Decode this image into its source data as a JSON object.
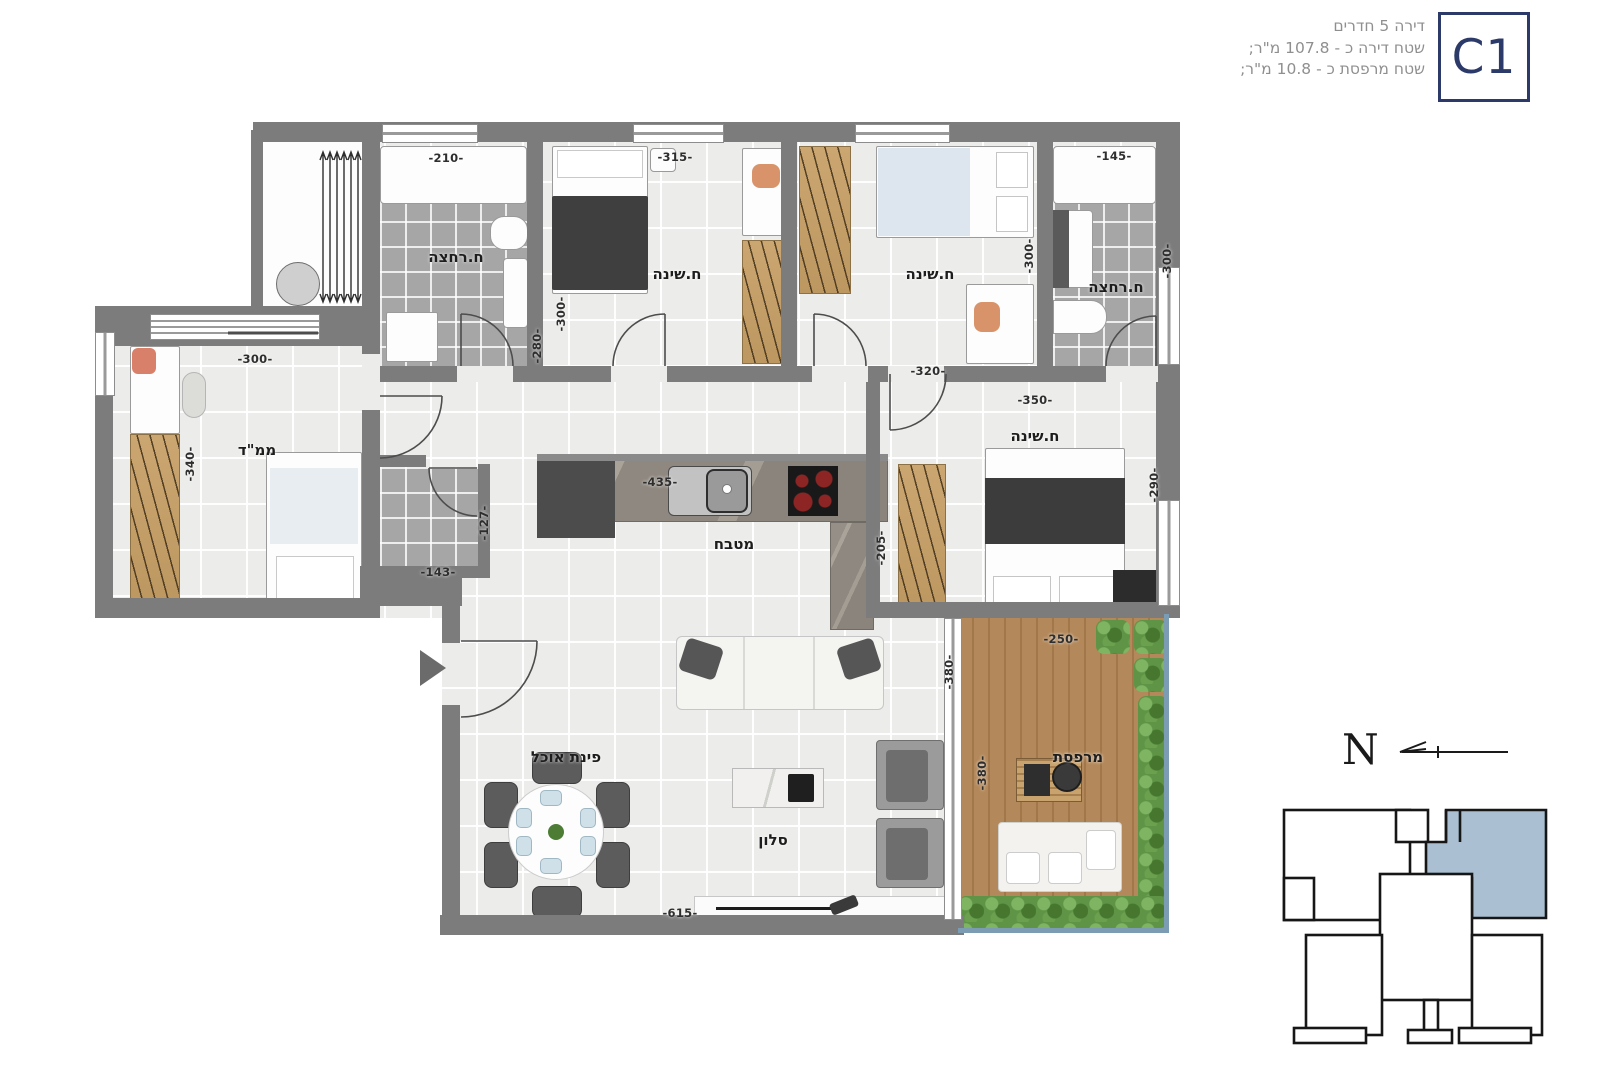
{
  "title_block": {
    "line1": "דירה 5 חדרים",
    "line2": "שטח דירה כ - 107.8 מ\"ר;",
    "line3": "שטח מרפסת כ - 10.8 מ\"ר;",
    "unit_code": "C1"
  },
  "rooms": {
    "bath1": {
      "label": "ח.רחצה",
      "width_dim": "-210-",
      "height_dim": "-280-"
    },
    "bed1": {
      "label": "ח.שינה",
      "width_dim": "-315-",
      "height_dim": "-300-"
    },
    "bed2": {
      "label": "ח.שינה",
      "width_dim": "-320-",
      "height_dim": "-300-"
    },
    "bath2": {
      "label": "ח.רחצה",
      "width_dim": "-145-",
      "height_dim": "-300-"
    },
    "mamad": {
      "label": "ממ\"ד",
      "width_dim": "-300-",
      "height_dim": "-340-"
    },
    "wc": {
      "width_dim": "-143-",
      "height_dim": "-127-"
    },
    "kitchen": {
      "label": "מטבח",
      "width_dim": "-435-",
      "height_dim": "-205-"
    },
    "bed3": {
      "label": "ח.שינה",
      "width_dim": "-350-",
      "height_dim": "-290-"
    },
    "living": {
      "label": "סלון",
      "width_dim": "-615-",
      "height_dim": "-380-"
    },
    "dining": {
      "label": "פינת אוכל"
    },
    "balcony": {
      "label": "מרפסת",
      "width_dim": "-250-",
      "height_dim": "-380-"
    }
  },
  "compass": {
    "north_label": "N"
  },
  "colors": {
    "wall": "#7c7c7c",
    "accent_navy": "#2b3a68",
    "keyplan_highlight": "#aabfd2",
    "wood": "#c5a06b",
    "deck": "#b08454",
    "plant": "#5f9447",
    "railing": "#7b9cb3"
  }
}
